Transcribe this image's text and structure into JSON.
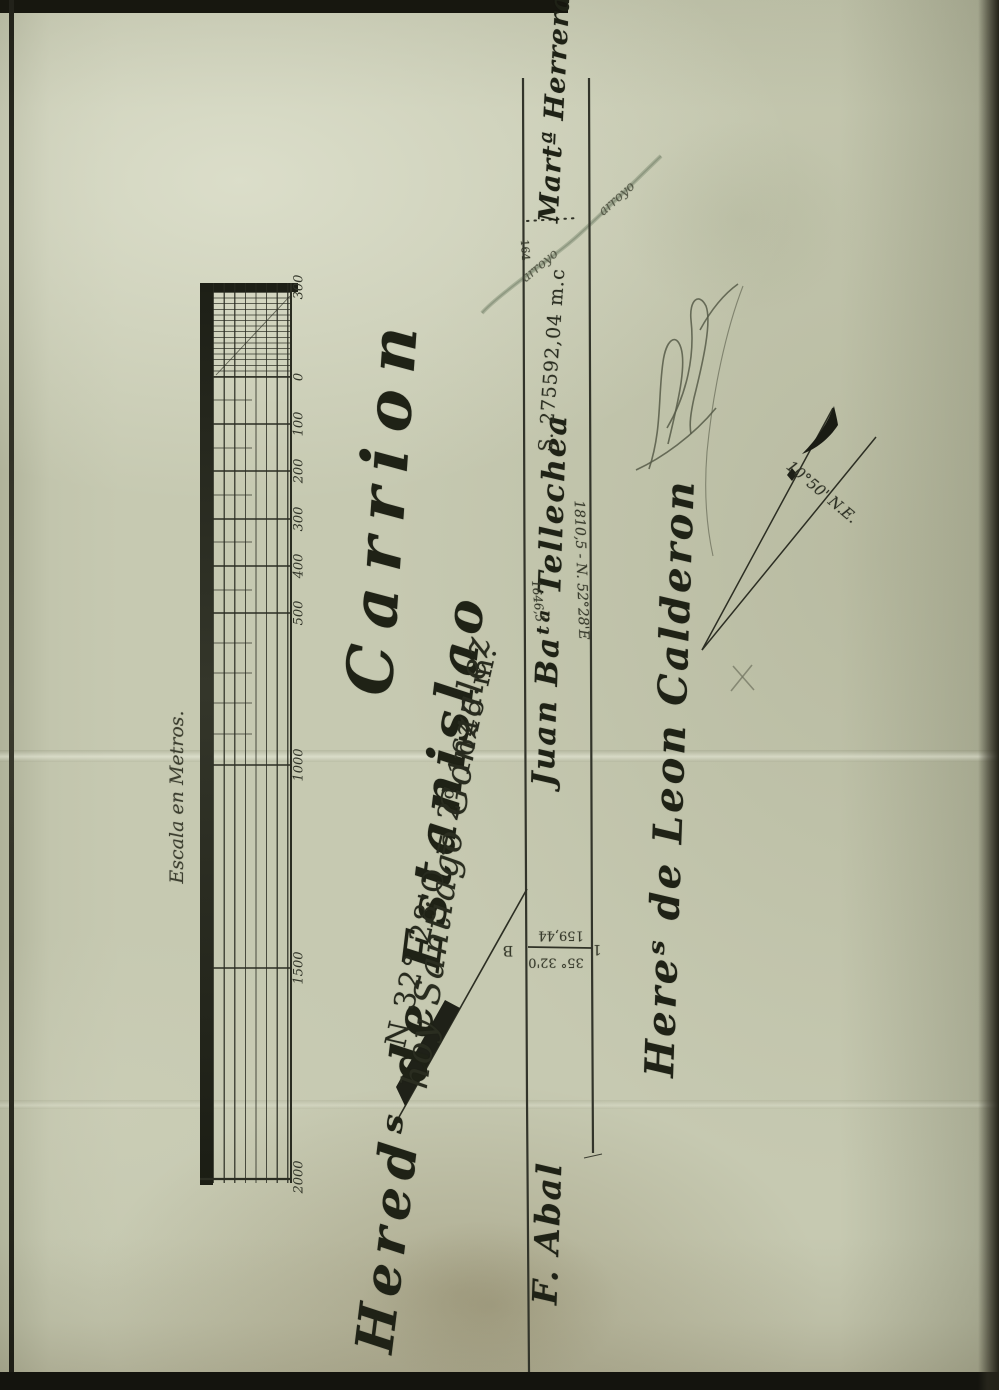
{
  "scale_bar": {
    "caption": "Escala en Metros.",
    "ticks": [
      "300",
      "0",
      "100",
      "200",
      "300",
      "400",
      "500",
      "1000",
      "1500",
      "2000"
    ]
  },
  "labels": {
    "hereds_estanislao": "Heredˢ de Estanislao",
    "carrion": "Carrion",
    "hoy_gonzalez": "hoy Santiago Gonzalez",
    "bearing_south": "N 32° 28'O = 2ᵈ 1645·m.",
    "tellechea": "Juan Baᵗᵃ Tellechea",
    "tellechea_area": "S. 275592,04 m.c",
    "herrera": "Martª Herrera",
    "road_bearing": "1810,5 - N. 52°28'E",
    "dist_1646": "1646,5",
    "calderon": "Hereˢ de Leon Calderon",
    "abal": "F. Abal",
    "declination": "10°50' N.E.",
    "tie_distance": "159,44",
    "tie_bearing": "35° 32'0",
    "tie_point_b": "B",
    "tie_point_1": "1",
    "offset_164": "164",
    "stream_upper": "arroyo",
    "stream_lower": "arroyo"
  }
}
